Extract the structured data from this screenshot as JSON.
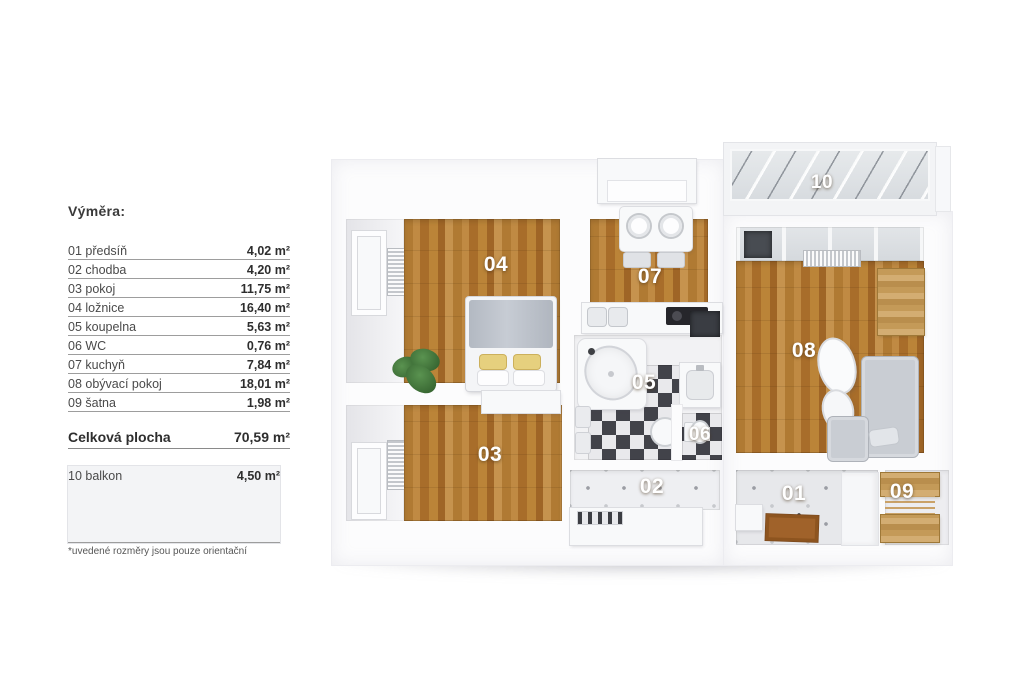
{
  "legend": {
    "title": "Výměra:",
    "rows": [
      {
        "name": "01 předsíň",
        "area": "4,02 m²"
      },
      {
        "name": "02 chodba",
        "area": "4,20 m²"
      },
      {
        "name": "03 pokoj",
        "area": "11,75 m²"
      },
      {
        "name": "04 ložnice",
        "area": "16,40 m²"
      },
      {
        "name": "05 koupelna",
        "area": "5,63 m²"
      },
      {
        "name": "06 WC",
        "area": "0,76 m²"
      },
      {
        "name": "07 kuchyň",
        "area": "7,84 m²"
      },
      {
        "name": "08 obývací pokoj",
        "area": "18,01 m²"
      },
      {
        "name": "09 šatna",
        "area": "1,98 m²"
      }
    ],
    "total": {
      "name": "Celková plocha",
      "area": "70,59 m²"
    },
    "balcony_row": {
      "name": "10 balkon",
      "area": "4,50 m²"
    },
    "footnote": "*uvedené rozměry jsou pouze orientační"
  },
  "floorplan": {
    "room_labels": {
      "r01": "01",
      "r02": "02",
      "r03": "03",
      "r04": "04",
      "r05": "05",
      "r06": "06",
      "r07": "07",
      "r08": "08",
      "r09": "09",
      "r10": "10"
    }
  },
  "colors": {
    "wood_floor": "#b5813c",
    "light_wood_furniture": "#c49a58",
    "checker_dark": "#42434a",
    "checker_light": "#e9e9ec",
    "sofa_grey": "#c9cdd3",
    "pillow_yellow": "#e6d07e",
    "doormat_brown": "#a0622a",
    "plant_green": "#3f7a36",
    "label_text": "#ffffff",
    "legend_text": "#3c3c3c"
  }
}
